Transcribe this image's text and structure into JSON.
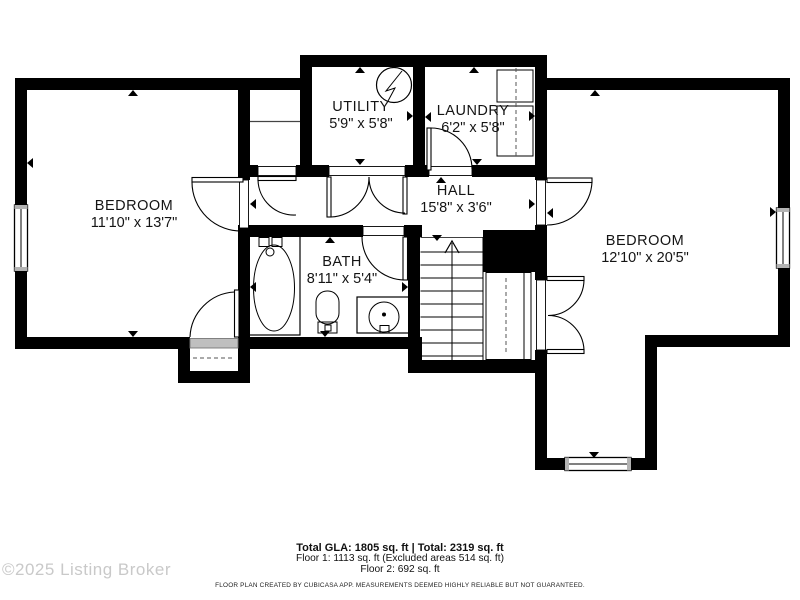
{
  "watermark": "©2025 Listing Broker",
  "plan": {
    "floor_label": "Floor 2",
    "rooms": {
      "bedroom_left": {
        "name": "BEDROOM",
        "dims": "11'10\" x 13'7\""
      },
      "utility": {
        "name": "UTILITY",
        "dims": "5'9\" x 5'8\""
      },
      "laundry": {
        "name": "LAUNDRY",
        "dims": "6'2\" x 5'8\""
      },
      "hall": {
        "name": "HALL",
        "dims": "15'8\" x 3'6\""
      },
      "bath": {
        "name": "BATH",
        "dims": "8'11\" x 5'4\""
      },
      "bedroom_right": {
        "name": "BEDROOM",
        "dims": "12'10\" x 20'5\""
      }
    },
    "fixture_icons": [
      "water-heater-icon",
      "washer-icon",
      "dryer-icon",
      "bathtub-icon",
      "toilet-icon",
      "sink-vanity-icon",
      "stairs-up-icon",
      "door-swing-icon",
      "window-icon",
      "closet-shelf-icon",
      "measurement-tick-icon"
    ]
  },
  "footer": {
    "totals": "Total GLA: 1805 sq. ft | Total: 2319 sq. ft",
    "floor1": "Floor 1: 1113 sq. ft (Excluded areas 514 sq. ft)",
    "floor2": "Floor 2: 692 sq. ft",
    "disclaimer": "FLOOR PLAN CREATED BY CUBICASA APP. MEASUREMENTS DEEMED HIGHLY RELIABLE BUT NOT GUARANTEED."
  },
  "colors": {
    "wall": "#000000",
    "background": "#ffffff",
    "watermark": "#c9c9c9",
    "label_text": "#141414",
    "threshold_gray": "#bfbfbf"
  }
}
